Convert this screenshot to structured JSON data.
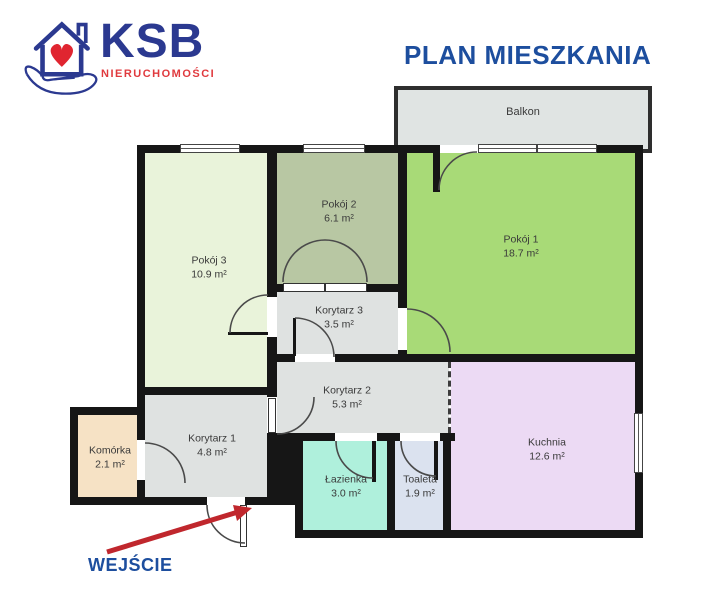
{
  "logo": {
    "brand": "KSB",
    "subtitle": "NIERUCHOMOŚCI",
    "icon": "house-heart-in-hand-icon"
  },
  "header": {
    "title": "PLAN MIESZKANIA"
  },
  "entrance": {
    "label": "WEJŚCIE"
  },
  "balcony": {
    "name": "Balkon",
    "color": "#e0e4e3"
  },
  "rooms": {
    "pokoj1": {
      "name": "Pokój 1",
      "area": "18.7 m²",
      "color": "#a8da77"
    },
    "pokoj2": {
      "name": "Pokój 2",
      "area": "6.1 m²",
      "color": "#b8c7a3"
    },
    "pokoj3": {
      "name": "Pokój 3",
      "area": "10.9 m²",
      "color": "#e9f3da"
    },
    "korytarz1": {
      "name": "Korytarz 1",
      "area": "4.8 m²",
      "color": "#dfe2e1"
    },
    "korytarz2": {
      "name": "Korytarz 2",
      "area": "5.3 m²",
      "color": "#dfe2e1"
    },
    "korytarz3": {
      "name": "Korytarz 3",
      "area": "3.5 m²",
      "color": "#dfe2e1"
    },
    "komorka": {
      "name": "Komórka",
      "area": "2.1 m²",
      "color": "#f6e2c5"
    },
    "lazienka": {
      "name": "Łazienka",
      "area": "3.0 m²",
      "color": "#aff0dc"
    },
    "toaleta": {
      "name": "Toaleta",
      "area": "1.9 m²",
      "color": "#dbe2ef"
    },
    "kuchnia": {
      "name": "Kuchnia",
      "area": "12.6 m²",
      "color": "#ecdaf4"
    }
  },
  "colors": {
    "title_blue": "#1d4e9e",
    "brand_blue": "#2b3990",
    "brand_red": "#e03a3e",
    "arrow_red": "#c0272d",
    "wall": "#161616"
  }
}
